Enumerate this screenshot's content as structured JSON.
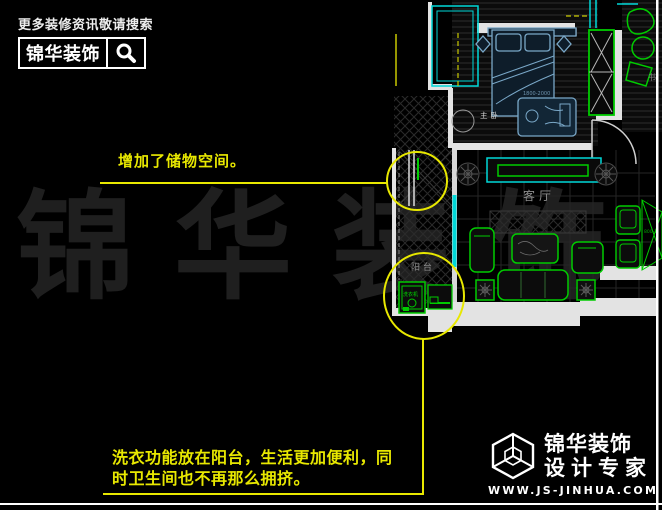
{
  "header": {
    "tagline": "更多装修资讯敬请搜索",
    "brand": "锦华装饰"
  },
  "callouts": {
    "storage": {
      "text": "增加了储物空间。"
    },
    "laundry": {
      "line1": "洗衣功能放在阳台，生活更加便利，同",
      "line2": "时卫生间也不再那么拥挤。"
    }
  },
  "watermark": {
    "text": "锦华装饰"
  },
  "floorplan": {
    "labels": {
      "master_bedroom": "主卧",
      "living_room": "客厅",
      "balcony": "阳台",
      "study": "书",
      "washer": "洗衣机",
      "bed_dimension": "1800-2000",
      "dining_dimension": "800-1"
    }
  },
  "footer": {
    "brand": "锦华装饰",
    "tagline": "设计专家",
    "website": "WWW.JS-JINHUA.COM"
  },
  "colors": {
    "annotation_yellow": "#e8e800",
    "cad_green": "#00cc00",
    "cad_cyan": "#00d8d8",
    "bed_blue": "#7aa8c8",
    "wall_white": "#e3e3e3"
  }
}
